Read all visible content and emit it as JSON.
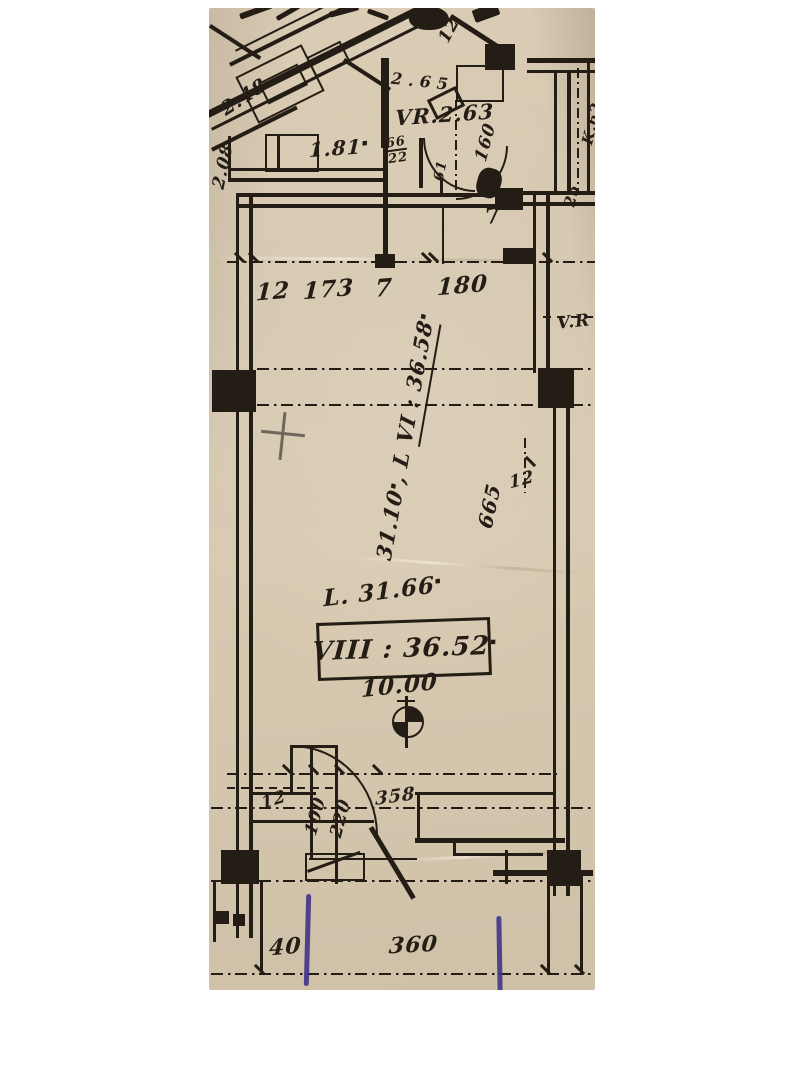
{
  "colors": {
    "page_bg": "#ffffff",
    "paper": "#d6c8b0",
    "ink": "#241d15",
    "pen_blue": "#3e3487",
    "pencil": "#6f665c"
  },
  "labels": {
    "sup_m2": "▪",
    "upper": {
      "dim_248": "2.48",
      "dim_208": "2.08",
      "area_181": "1.81",
      "vr_263": "VR.2.63",
      "dim_160": "160",
      "door_66": "66",
      "door_22": "22",
      "door_61": "61",
      "dim_12": "12",
      "dim_265": "2.65",
      "k62": "K.62",
      "k25": "25"
    },
    "top_dims": {
      "d12": "12",
      "d173": "173",
      "d7": "7",
      "d180": "180",
      "strip_7": "7"
    },
    "room": {
      "rot_prefix": "31.10",
      "rot_mid": ", L ",
      "rot_main": "VI : 36.58",
      "l_area": "L. 31.66",
      "viii": "VIII : 36.52",
      "ten": "10.00",
      "dim_665": "665",
      "dim_12": "12",
      "vr_right": "V.R"
    },
    "door_dims": {
      "d12": "12",
      "d100": "100",
      "d220": "220",
      "d358": "358"
    },
    "bottom_dims": {
      "d40": "40",
      "d360": "360"
    }
  }
}
